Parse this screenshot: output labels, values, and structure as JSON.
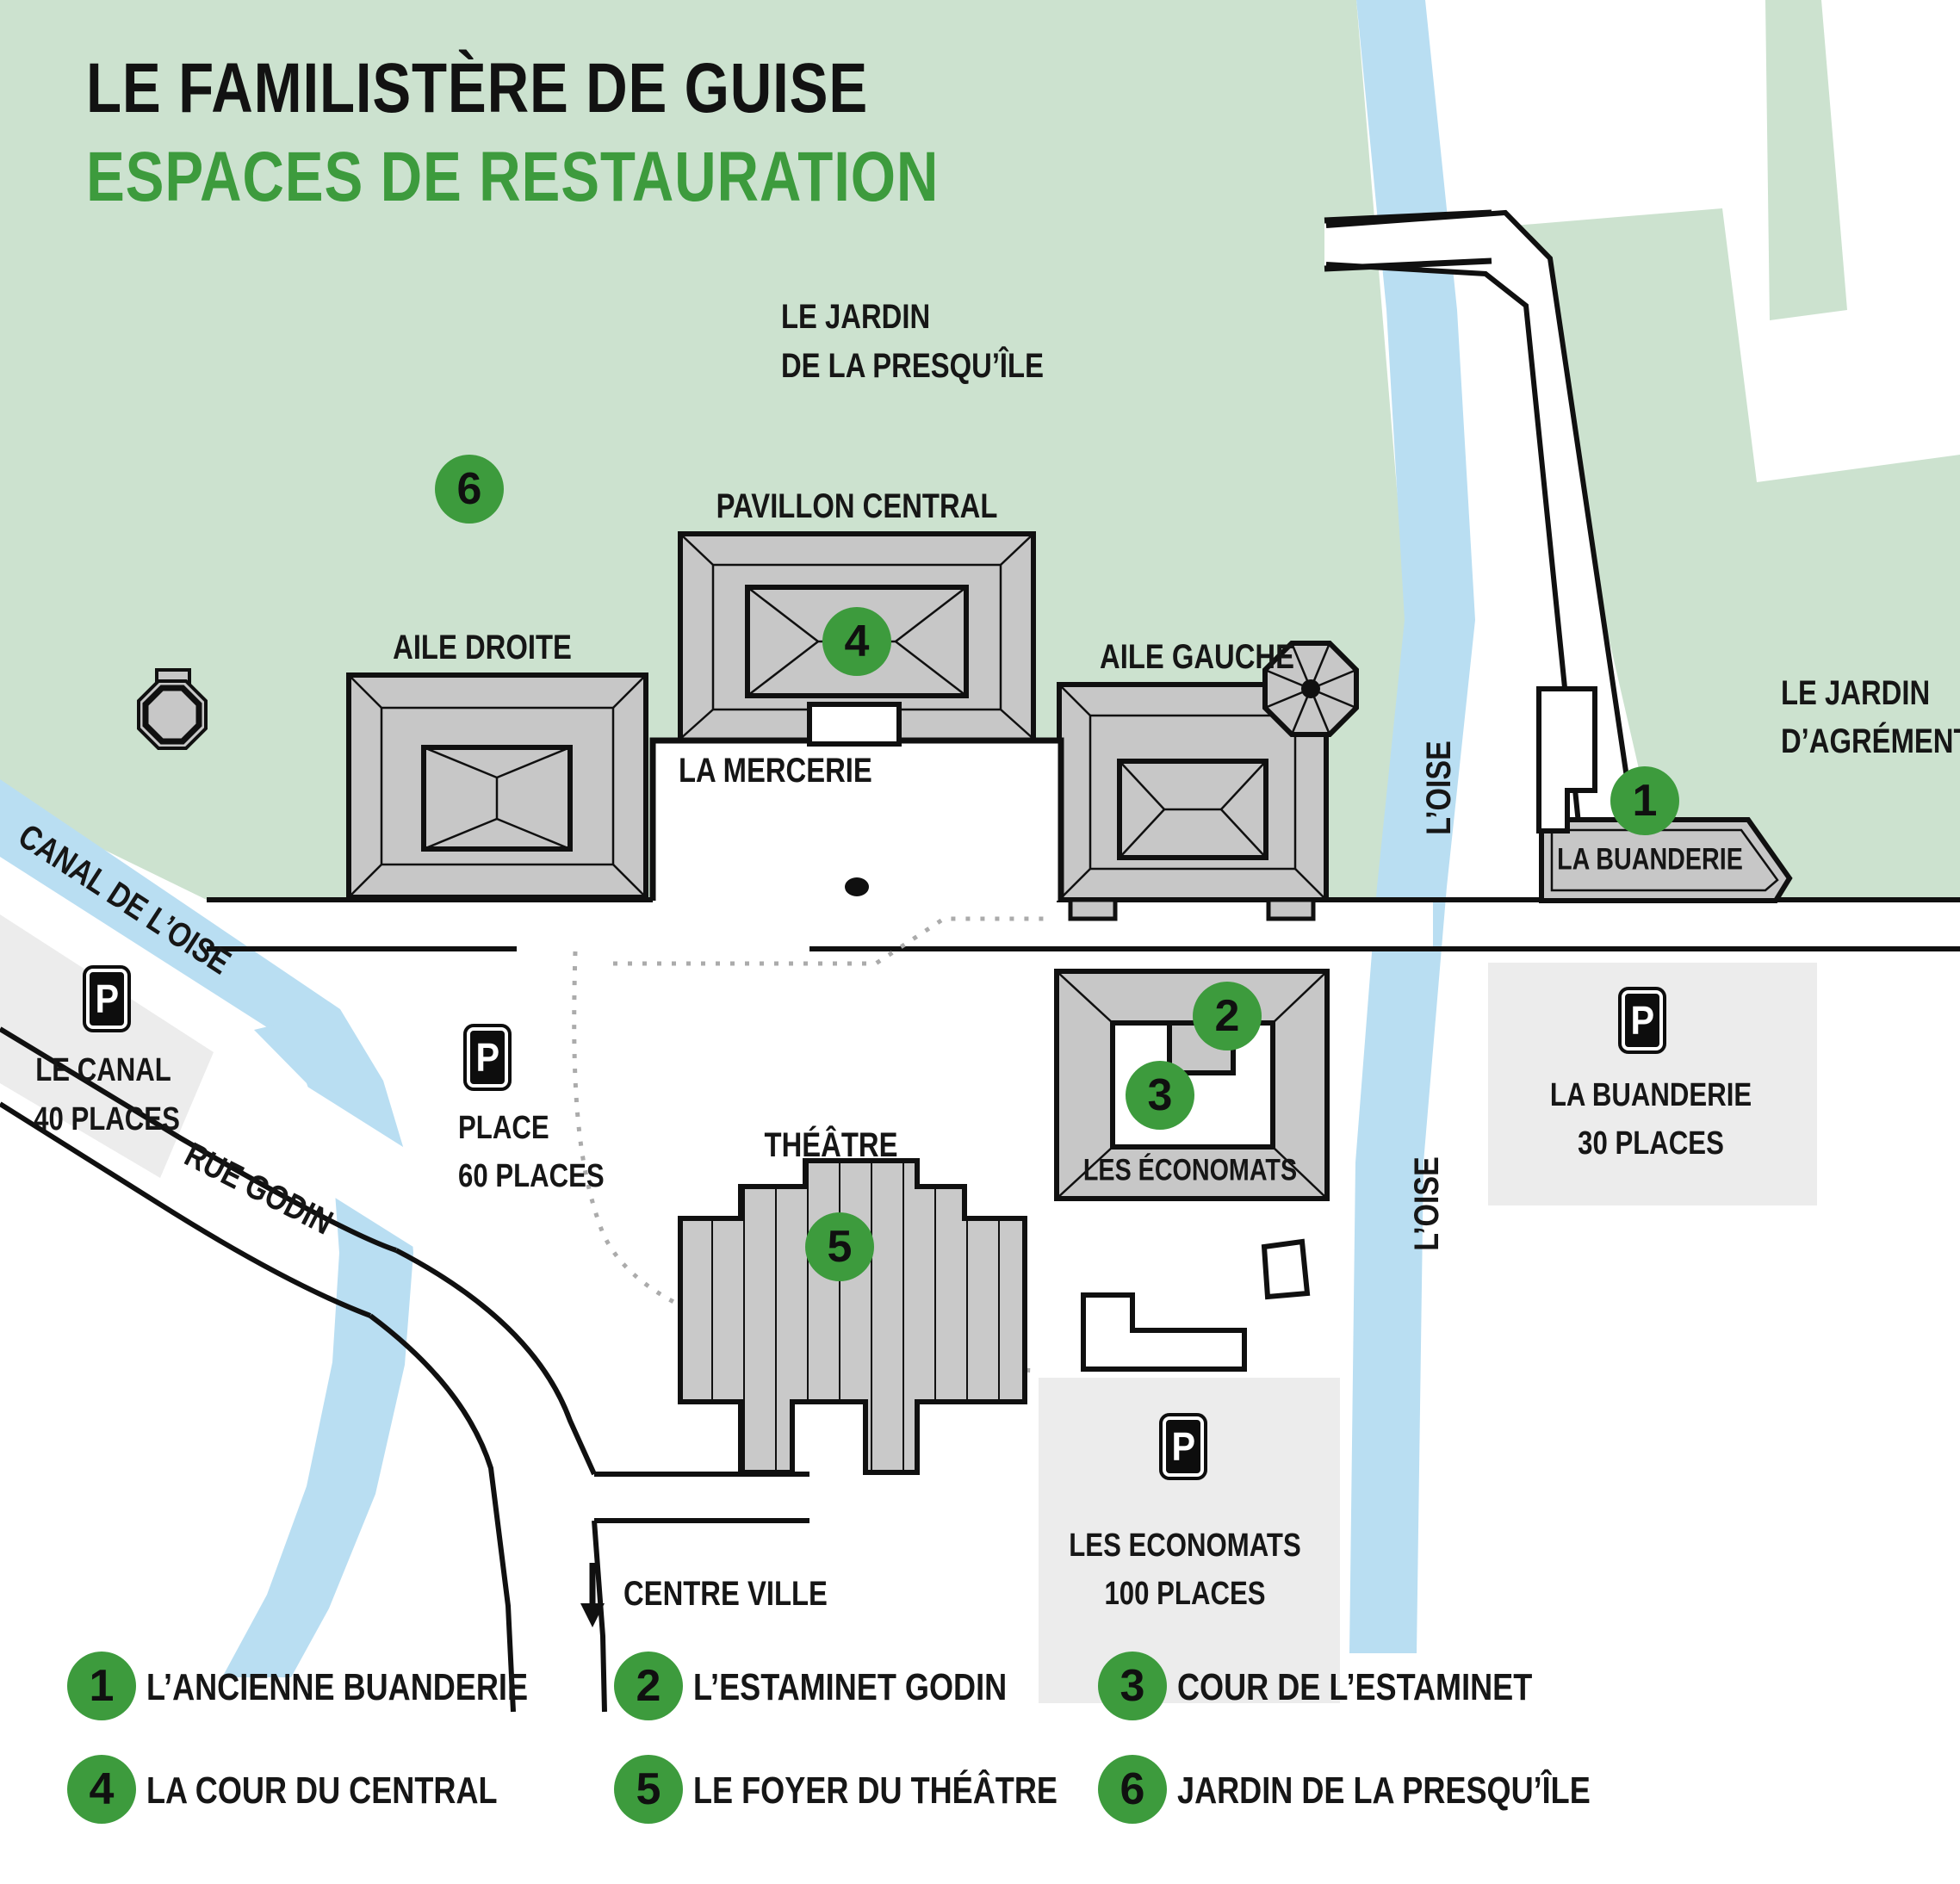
{
  "title": {
    "line1": "LE FAMILISTÈRE DE GUISE",
    "subtitle": "ESPACES DE RESTAURATION"
  },
  "colors": {
    "accent_green": "#3d9b3d",
    "park_green": "#cce2cf",
    "water_blue": "#b9def2",
    "building_gray": "#c7c7c7",
    "parking_gray": "#ececec",
    "text_black": "#161616"
  },
  "map": {
    "labels": {
      "jardin_presquile_l1": "LE JARDIN",
      "jardin_presquile_l2": "DE LA PRESQU’ÎLE",
      "pavillon_central": "PAVILLON CENTRAL",
      "aile_droite": "AILE DROITE",
      "aile_gauche": "AILE GAUCHE",
      "la_mercerie": "LA MERCERIE",
      "la_buanderie": "LA BUANDERIE",
      "les_economats": "LES ÉCONOMATS",
      "theatre": "THÉÂTRE",
      "jardin_agrement_l1": "LE JARDIN",
      "jardin_agrement_l2": "D’AGRÉMENT",
      "canal": "CANAL DE L’OISE",
      "rue_godin": "RUE GODIN",
      "centre_ville": "CENTRE VILLE",
      "oise_upper": "L’OISE",
      "oise_lower": "L’OISE"
    },
    "markers": {
      "m1": "1",
      "m2": "2",
      "m3": "3",
      "m4": "4",
      "m5": "5",
      "m6": "6"
    },
    "parkings": [
      {
        "id": "canal",
        "symbol": "P",
        "name": "LE CANAL",
        "capacity": "40 PLACES"
      },
      {
        "id": "place",
        "symbol": "P",
        "name": "PLACE",
        "capacity": "60 PLACES"
      },
      {
        "id": "buanderie",
        "symbol": "P",
        "name": "LA BUANDERIE",
        "capacity": "30 PLACES"
      },
      {
        "id": "economats",
        "symbol": "P",
        "name": "LES ECONOMATS",
        "capacity": "100 PLACES"
      }
    ]
  },
  "legend": {
    "items": [
      {
        "number": "1",
        "label": "L’ANCIENNE BUANDERIE"
      },
      {
        "number": "2",
        "label": "L’ESTAMINET GODIN"
      },
      {
        "number": "3",
        "label": "COUR DE L’ESTAMINET"
      },
      {
        "number": "4",
        "label": "LA COUR DU CENTRAL"
      },
      {
        "number": "5",
        "label": "LE FOYER DU THÉÂTRE"
      },
      {
        "number": "6",
        "label": "JARDIN DE LA PRESQU’ÎLE"
      }
    ]
  }
}
